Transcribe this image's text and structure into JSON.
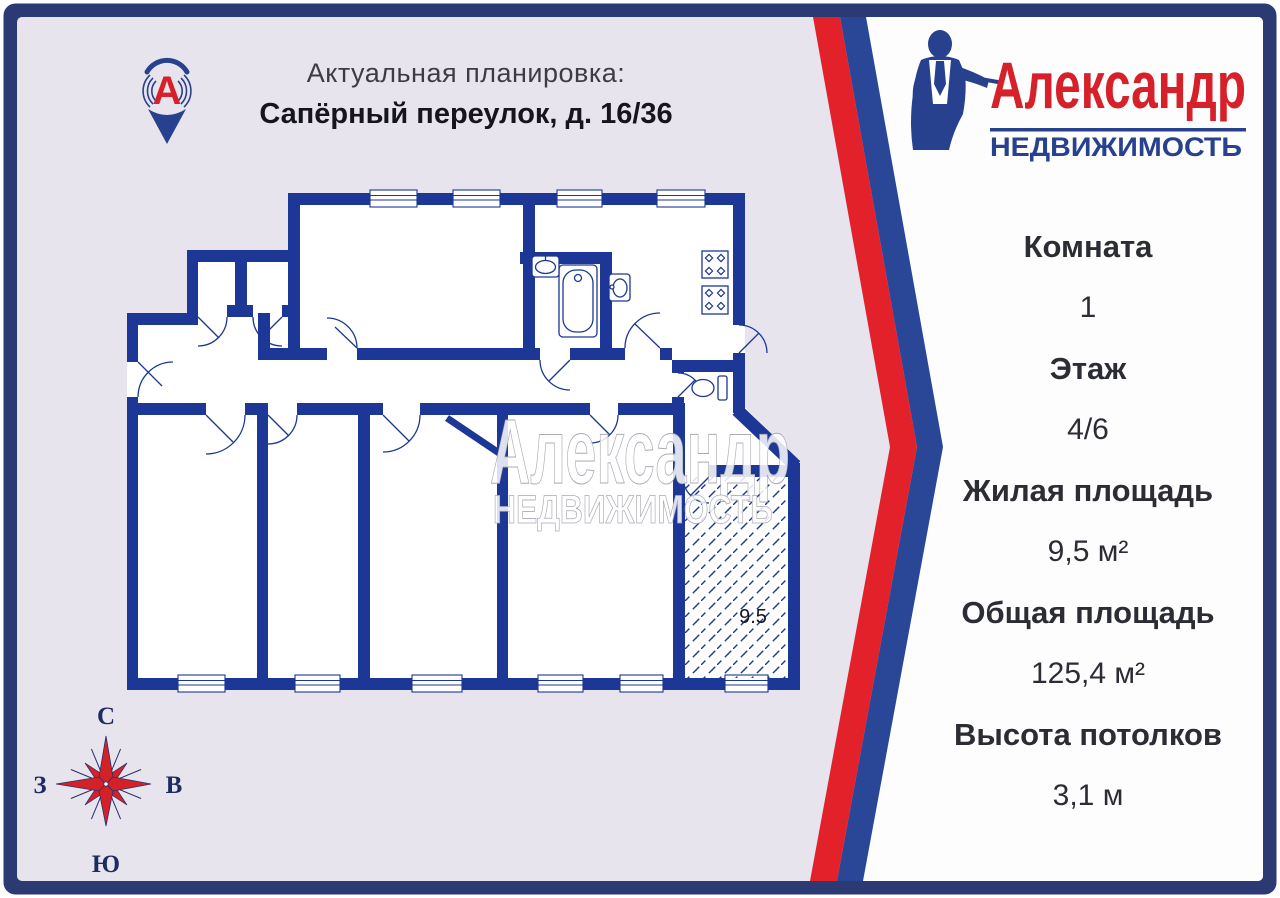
{
  "header": {
    "pin_letter": "А",
    "title": "Актуальная планировка:",
    "address": "Сапёрный переулок, д. 16/36"
  },
  "logo": {
    "brand": "Александр",
    "subtitle": "НЕДВИЖИМОСТЬ"
  },
  "watermark": {
    "line1": "Александр",
    "line2": "НЕДВИЖИМОСТЬ"
  },
  "plan": {
    "area_label": "9.5"
  },
  "compass": {
    "north": "С",
    "south": "Ю",
    "west": "З",
    "east": "В"
  },
  "details": [
    {
      "label": "Комната",
      "value": "1"
    },
    {
      "label": "Этаж",
      "value": "4/6"
    },
    {
      "label": "Жилая площадь",
      "value": "9,5 м²"
    },
    {
      "label": "Общая площадь",
      "value": "125,4 м²"
    },
    {
      "label": "Высота потолков",
      "value": "3,1 м"
    }
  ],
  "colors": {
    "frame_navy": "#2c3a74",
    "wall_navy": "#1c3795",
    "stripe_red": "#e3212b",
    "stripe_blue": "#2a4697",
    "logo_red": "#d6212b",
    "logo_blue": "#27418f",
    "lavender_bg": "#e7e4ee",
    "panel_white": "#fdfdfe",
    "text_dark": "#2c2d34"
  }
}
